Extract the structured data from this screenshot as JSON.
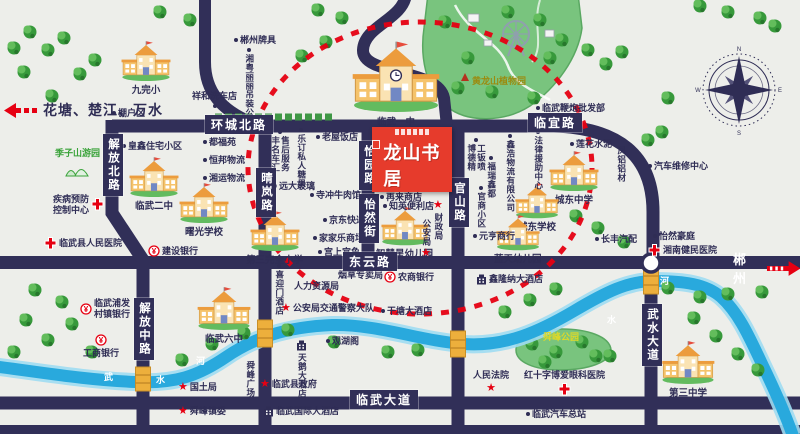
{
  "map": {
    "project": {
      "name": "龙山书居"
    },
    "direction_signs": {
      "west": "花塘、楚江、万水",
      "east": "郴州"
    },
    "road_labels": [
      {
        "text": "环城北路",
        "x": 205,
        "y": 115,
        "vert": false
      },
      {
        "text": "临宜路",
        "x": 528,
        "y": 113,
        "vert": false
      },
      {
        "text": "东云路",
        "x": 343,
        "y": 252,
        "vert": false
      },
      {
        "text": "临武大道",
        "x": 350,
        "y": 390,
        "vert": false
      },
      {
        "text": "晴岚路",
        "x": 256,
        "y": 168,
        "vert": true
      },
      {
        "text": "解放北路",
        "x": 103,
        "y": 134,
        "vert": true
      },
      {
        "text": "解放中路",
        "x": 134,
        "y": 298,
        "vert": true
      },
      {
        "text": "怡园路",
        "x": 359,
        "y": 141,
        "vert": true
      },
      {
        "text": "怡然街",
        "x": 359,
        "y": 194,
        "vert": true
      },
      {
        "text": "官山路",
        "x": 449,
        "y": 178,
        "vert": true
      },
      {
        "text": "武水大道",
        "x": 642,
        "y": 304,
        "vert": true
      }
    ],
    "river_labels": [
      {
        "text": "武",
        "x": 104,
        "y": 370
      },
      {
        "text": "水",
        "x": 156,
        "y": 373
      },
      {
        "text": "河",
        "x": 196,
        "y": 354
      },
      {
        "text": "水",
        "x": 607,
        "y": 313
      },
      {
        "text": "河",
        "x": 660,
        "y": 274
      }
    ],
    "schools": [
      {
        "name": "九完小",
        "x": 120,
        "y": 40,
        "w": 52,
        "big": false
      },
      {
        "name": "临武一中",
        "x": 350,
        "y": 40,
        "w": 92,
        "big": true
      },
      {
        "name": "临武二中",
        "x": 128,
        "y": 156,
        "w": 52,
        "big": false
      },
      {
        "name": "曙光学校",
        "x": 178,
        "y": 182,
        "w": 52,
        "big": false
      },
      {
        "name": "第三完全小学",
        "x": 246,
        "y": 210,
        "w": 52,
        "big": false
      },
      {
        "name": "智慧星幼儿园",
        "x": 376,
        "y": 206,
        "w": 50,
        "big": false
      },
      {
        "name": "城东中学",
        "x": 548,
        "y": 150,
        "w": 52,
        "big": false
      },
      {
        "name": "城东学校",
        "x": 514,
        "y": 182,
        "w": 46,
        "big": false
      },
      {
        "name": "蓝天幼儿园",
        "x": 494,
        "y": 214,
        "w": 46,
        "big": false
      },
      {
        "name": "临武六中",
        "x": 196,
        "y": 286,
        "w": 56,
        "big": false
      },
      {
        "name": "第三中学",
        "x": 660,
        "y": 340,
        "w": 56,
        "big": false
      }
    ],
    "pois": [
      {
        "label": "郴州牌具",
        "x": 234,
        "y": 35,
        "icon": "dot",
        "pos": "left"
      },
      {
        "label": "湘粤丽丽吊装公司",
        "x": 244,
        "y": 48,
        "icon": "dot",
        "pos": "above",
        "vert": true
      },
      {
        "label": "祥和洗车店",
        "x": 192,
        "y": 91,
        "icon": "dot",
        "pos": "below"
      },
      {
        "label": "棚户区",
        "x": 112,
        "y": 108,
        "icon": "dot",
        "pos": "left"
      },
      {
        "label": "临武鞭炮批发部",
        "x": 536,
        "y": 103,
        "icon": "dot",
        "pos": "left"
      },
      {
        "label": "黄龙山植物园",
        "x": 472,
        "y": 76,
        "icon": "none",
        "color": "#9b8b10"
      },
      {
        "label": "季子山游园",
        "x": 55,
        "y": 148,
        "icon": "park",
        "pos": "below",
        "color": "#3aa33a"
      },
      {
        "label": "皇鑫住宅小区",
        "x": 122,
        "y": 141,
        "icon": "dot",
        "pos": "left"
      },
      {
        "label": "疾病预防\n控制中心",
        "x": 53,
        "y": 194,
        "icon": "cross",
        "pos": "right",
        "ml": true
      },
      {
        "label": "临武县人民医院",
        "x": 44,
        "y": 237,
        "icon": "cross",
        "pos": "left"
      },
      {
        "label": "建设银行",
        "x": 148,
        "y": 245,
        "icon": "bank",
        "pos": "left"
      },
      {
        "label": "都福苑",
        "x": 203,
        "y": 137,
        "icon": "dot",
        "pos": "left"
      },
      {
        "label": "恒邦物流",
        "x": 203,
        "y": 155,
        "icon": "dot",
        "pos": "left"
      },
      {
        "label": "湘运物流",
        "x": 203,
        "y": 173,
        "icon": "dot",
        "pos": "left"
      },
      {
        "label": "丰名车汇\n售后服务",
        "x": 270,
        "y": 130,
        "icon": "dot",
        "pos": "above",
        "vert": true
      },
      {
        "label": "乐订私人糖果",
        "x": 296,
        "y": 128,
        "icon": "dot",
        "pos": "above",
        "vert": true
      },
      {
        "label": "老屋饭店",
        "x": 316,
        "y": 132,
        "icon": "dot",
        "pos": "left"
      },
      {
        "label": "远大玻璃",
        "x": 273,
        "y": 181,
        "icon": "dot",
        "pos": "left"
      },
      {
        "label": "寺冲牛肉馆",
        "x": 310,
        "y": 190,
        "icon": "dot",
        "pos": "left"
      },
      {
        "label": "京东快递",
        "x": 323,
        "y": 215,
        "icon": "dot",
        "pos": "left"
      },
      {
        "label": "家家乐商场",
        "x": 313,
        "y": 233,
        "icon": "dot",
        "pos": "left"
      },
      {
        "label": "宫上宫鱼",
        "x": 318,
        "y": 247,
        "icon": "dot",
        "pos": "left"
      },
      {
        "label": "再来商店",
        "x": 380,
        "y": 192,
        "icon": "dot",
        "pos": "left"
      },
      {
        "label": "知英便利店",
        "x": 383,
        "y": 201,
        "icon": "dot",
        "pos": "left"
      },
      {
        "label": "公安局",
        "x": 421,
        "y": 219,
        "icon": "star",
        "pos": "below",
        "vert": true
      },
      {
        "label": "财政局",
        "x": 433,
        "y": 200,
        "icon": "star",
        "pos": "above",
        "vert": true
      },
      {
        "label": "博德精\n工钣喷",
        "x": 466,
        "y": 138,
        "icon": "dot",
        "pos": "above",
        "vert": true
      },
      {
        "label": "福瑞鑫都",
        "x": 486,
        "y": 156,
        "icon": "dot",
        "pos": "above",
        "vert": true
      },
      {
        "label": "鑫浩物流有限公司",
        "x": 505,
        "y": 134,
        "icon": "dot",
        "pos": "above",
        "vert": true
      },
      {
        "label": "官商小区",
        "x": 476,
        "y": 186,
        "icon": "dot",
        "pos": "above",
        "vert": true
      },
      {
        "label": "元亨商行",
        "x": 473,
        "y": 231,
        "icon": "dot",
        "pos": "left"
      },
      {
        "label": "法律援助中心",
        "x": 533,
        "y": 130,
        "icon": "dot",
        "pos": "above",
        "vert": true
      },
      {
        "label": "莲花水泥",
        "x": 570,
        "y": 139,
        "icon": "dot",
        "pos": "left"
      },
      {
        "label": "凤铝铝材",
        "x": 616,
        "y": 146,
        "icon": "none",
        "vert": true
      },
      {
        "label": "汽车维修中心",
        "x": 648,
        "y": 161,
        "icon": "dot",
        "pos": "left"
      },
      {
        "label": "长丰汽配",
        "x": 595,
        "y": 234,
        "icon": "dot",
        "pos": "left"
      },
      {
        "label": "怡然豪庭",
        "x": 653,
        "y": 231,
        "icon": "dot",
        "pos": "left"
      },
      {
        "label": "湘南健民医院",
        "x": 648,
        "y": 244,
        "icon": "cross",
        "pos": "left"
      },
      {
        "label": "农商银行",
        "x": 384,
        "y": 271,
        "icon": "bank",
        "pos": "left"
      },
      {
        "label": "喜迎门酒店",
        "x": 274,
        "y": 264,
        "icon": "dot",
        "pos": "above",
        "vert": true
      },
      {
        "label": "人力资源局",
        "x": 294,
        "y": 281,
        "icon": "none"
      },
      {
        "label": "烟草专卖局",
        "x": 338,
        "y": 270,
        "icon": "none"
      },
      {
        "label": "公安局交通警察大队",
        "x": 281,
        "y": 303,
        "icon": "star",
        "pos": "left"
      },
      {
        "label": "临武浦发\n村镇银行",
        "x": 80,
        "y": 298,
        "icon": "bank",
        "pos": "left",
        "ml": true
      },
      {
        "label": "工商银行",
        "x": 83,
        "y": 334,
        "icon": "bank",
        "pos": "above"
      },
      {
        "label": "干塘大酒店",
        "x": 381,
        "y": 306,
        "icon": "dot",
        "pos": "left"
      },
      {
        "label": "鑫隆纳大酒店",
        "x": 476,
        "y": 274,
        "icon": "hotel",
        "pos": "left"
      },
      {
        "label": "观湖阁",
        "x": 326,
        "y": 336,
        "icon": "dot",
        "pos": "left"
      },
      {
        "label": "天鹅大酒店",
        "x": 296,
        "y": 340,
        "icon": "hotel",
        "pos": "above",
        "vert": true
      },
      {
        "label": "舜峰广场",
        "x": 245,
        "y": 361,
        "icon": "none",
        "vert": true
      },
      {
        "label": "国土局",
        "x": 178,
        "y": 382,
        "icon": "star",
        "pos": "left"
      },
      {
        "label": "舜峰镇委",
        "x": 178,
        "y": 406,
        "icon": "star",
        "pos": "left"
      },
      {
        "label": "临武县政府",
        "x": 260,
        "y": 379,
        "icon": "star",
        "pos": "left"
      },
      {
        "label": "临武国际大酒店",
        "x": 263,
        "y": 406,
        "icon": "hotel",
        "pos": "left"
      },
      {
        "label": "人民法院",
        "x": 473,
        "y": 370,
        "icon": "star",
        "pos": "below"
      },
      {
        "label": "红十字博爱眼科医院",
        "x": 524,
        "y": 370,
        "icon": "cross",
        "pos": "below"
      },
      {
        "label": "舜峰公园",
        "x": 543,
        "y": 332,
        "icon": "none",
        "color": "#ddd829"
      },
      {
        "label": "临武汽车总站",
        "x": 526,
        "y": 409,
        "icon": "dot",
        "pos": "left"
      }
    ],
    "colors": {
      "background": "#edeeea",
      "road": "#312f58",
      "river": "#29a9dd",
      "accent_red": "#e60012",
      "park_green": "#79c47e",
      "bridge": "#edaf3c",
      "project_red": "#e63b2c"
    }
  }
}
